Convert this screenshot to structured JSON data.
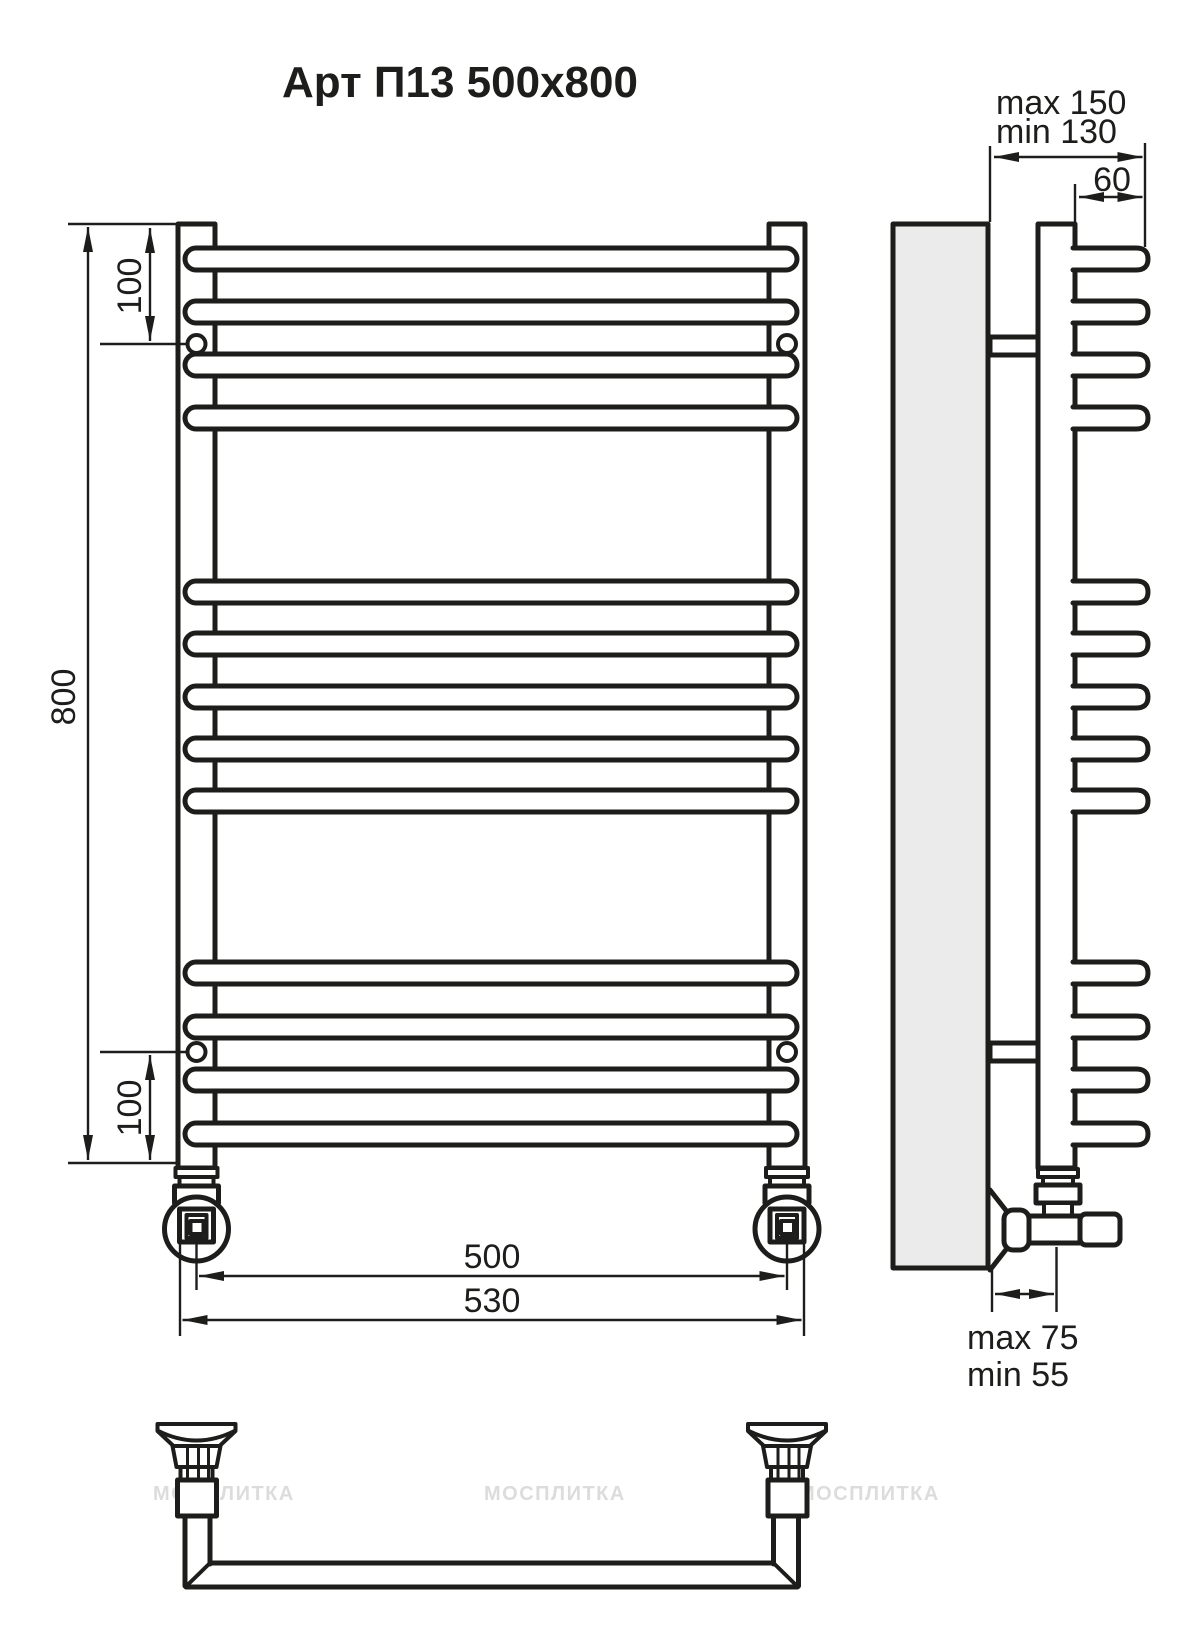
{
  "annotations": {
    "title": "Арт П13 500x800",
    "dim_height": "800",
    "dim_top_offset": "100",
    "dim_bottom_offset": "100",
    "dim_axis_width": "500",
    "dim_overall_width": "530",
    "dim_wall_max": "max 150",
    "dim_wall_min": "min 130",
    "dim_bar_depth": "60",
    "dim_valve_max": "max 75",
    "dim_valve_min": "min 55",
    "watermark": "МОСПЛИТКА"
  },
  "colors": {
    "line": "#1d1d1b",
    "wall_fill": "#ebebeb",
    "background": "#ffffff",
    "watermark": "#dcdcdc"
  },
  "drawing": {
    "bar_rows_y": [
      259,
      312,
      365,
      418,
      592,
      644,
      697,
      749,
      801,
      973,
      1027,
      1080,
      1134
    ],
    "bar_groups": [
      4,
      5,
      4
    ],
    "front_column_centers_x": [
      196.5,
      787
    ],
    "bottom_assembly_centers_x": [
      196.5,
      787
    ],
    "watermark_positions_x": [
      153,
      484,
      798
    ]
  }
}
